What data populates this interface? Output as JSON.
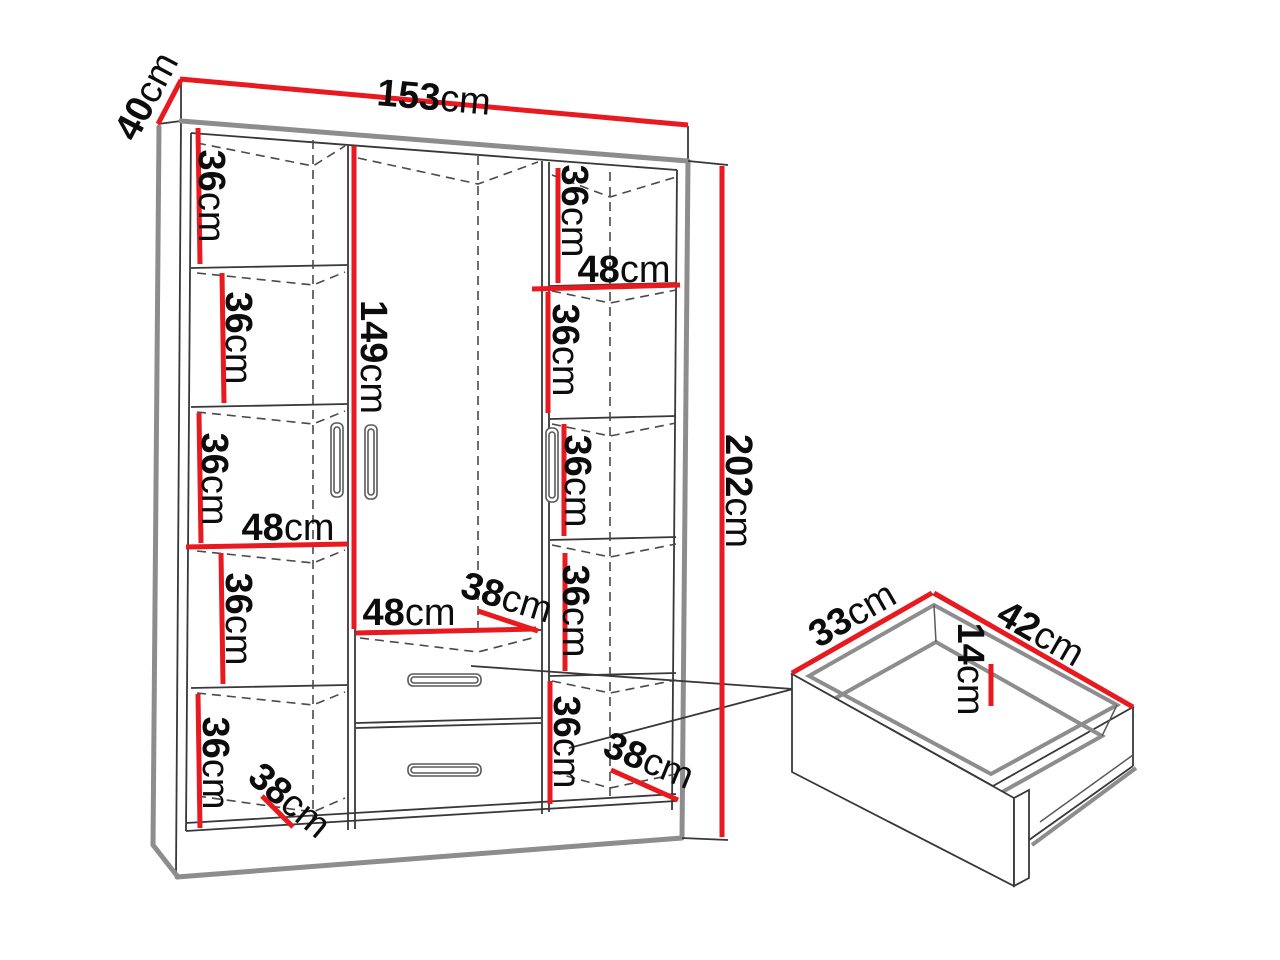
{
  "diagram": {
    "unit": "cm",
    "wardrobe": {
      "width_cm": 153,
      "depth_cm": 40,
      "height_cm": 202,
      "hanging_space_height_cm": 149,
      "compartment_width_cm": 48,
      "compartment_height_cm": 36,
      "compartment_depth_cm": 38,
      "left_column_compartments": [
        36,
        36,
        36,
        36,
        36
      ],
      "right_column_compartments": [
        36,
        36,
        36,
        36,
        36
      ]
    },
    "drawer": {
      "inner_depth_cm": 33,
      "inner_width_cm": 42,
      "inner_height_cm": 14
    }
  },
  "labels": {
    "depth40": {
      "num": "40",
      "unit": "cm"
    },
    "width153": {
      "num": "153",
      "unit": "cm"
    },
    "left36_1": {
      "num": "36",
      "unit": "cm"
    },
    "left36_2": {
      "num": "36",
      "unit": "cm"
    },
    "left36_3": {
      "num": "36",
      "unit": "cm"
    },
    "left36_4": {
      "num": "36",
      "unit": "cm"
    },
    "left36_5": {
      "num": "36",
      "unit": "cm"
    },
    "left48": {
      "num": "48",
      "unit": "cm"
    },
    "height149": {
      "num": "149",
      "unit": "cm"
    },
    "right36_1": {
      "num": "36",
      "unit": "cm"
    },
    "right36_2": {
      "num": "36",
      "unit": "cm"
    },
    "right36_3": {
      "num": "36",
      "unit": "cm"
    },
    "right36_4": {
      "num": "36",
      "unit": "cm"
    },
    "right36_5": {
      "num": "36",
      "unit": "cm"
    },
    "right48": {
      "num": "48",
      "unit": "cm"
    },
    "height202": {
      "num": "202",
      "unit": "cm"
    },
    "center48": {
      "num": "48",
      "unit": "cm"
    },
    "center38": {
      "num": "38",
      "unit": "cm"
    },
    "bottomleft38": {
      "num": "38",
      "unit": "cm"
    },
    "bottomright38": {
      "num": "38",
      "unit": "cm"
    },
    "drawer33": {
      "num": "33",
      "unit": "cm"
    },
    "drawer42": {
      "num": "42",
      "unit": "cm"
    },
    "drawer14": {
      "num": "14",
      "unit": "cm"
    }
  },
  "colors": {
    "dimension_line": "#e8191f",
    "structure_thick": "#8d8d8d",
    "structure_thin": "#383838",
    "label": "#0c0c0c",
    "background": "#ffffff"
  }
}
